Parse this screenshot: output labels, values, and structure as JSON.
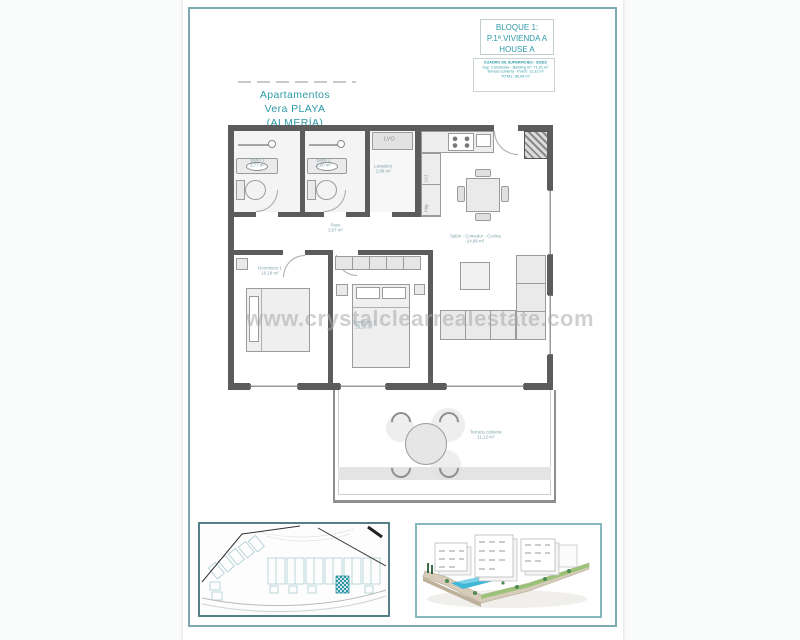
{
  "header": {
    "project_line1": "Apartamentos",
    "project_line2": "Vera PLAYA",
    "project_line3": "(ALMERÍA)"
  },
  "title_block": {
    "line1": "BLOQUE 1:",
    "line2": "P.1ª.VIVIENDA A",
    "line3": "HOUSE A"
  },
  "area_table": {
    "title": "CUADRO DE SUPERFICIES - SIZES",
    "row1": "Sup. Construida - Building m²: 71,91 m²",
    "row2": "Terraza cubierta - Porch: 11,12 m²",
    "row3": "TOTAL: 80,05 m²"
  },
  "watermark": "www.crystalclearrealestate.com",
  "plan": {
    "rooms": {
      "bath1": {
        "name": "Baño 1",
        "area": "3,77 m²"
      },
      "bath2": {
        "name": "Baño 2",
        "area": "3,60 m²"
      },
      "laundry": {
        "name": "Lavadero",
        "area": "1,98 m²"
      },
      "hall": {
        "name": "Paso",
        "area": "3,97 m²"
      },
      "bedroom1": {
        "name": "Dormitorio 1",
        "area": "10,18 m²"
      },
      "bedroom2": {
        "name": "Dormitorio 2",
        "area": "10,50 m²"
      },
      "living": {
        "name": "Salón - Comedor - Cocina",
        "area": "24,89 m²"
      },
      "terrace": {
        "name": "Terraza cubierta",
        "area": "11,12 m²"
      }
    },
    "appliances": {
      "washer": "LVO",
      "dishwasher": "LVJ",
      "fridge": "Frig"
    }
  },
  "colors": {
    "teal_text": "#2d9aa8",
    "page_border": "#7fa9b1",
    "wall": "#5c5c5c",
    "highlight_hatch": "#2f96a3",
    "pool_blue": "#3fb8d8"
  }
}
